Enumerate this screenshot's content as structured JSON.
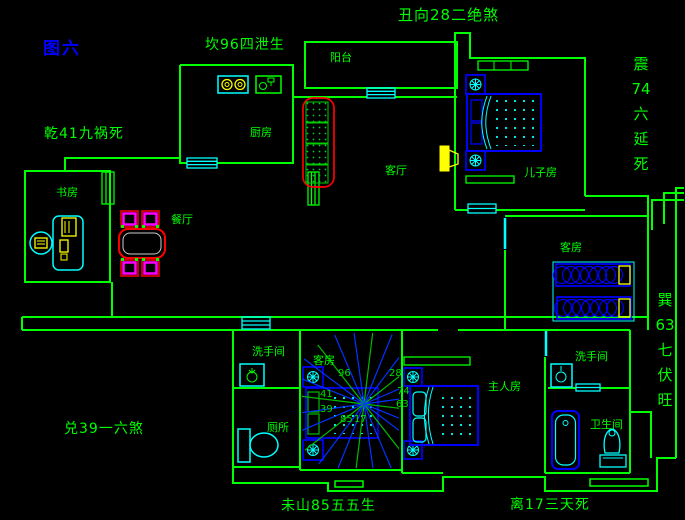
{
  "figure": {
    "label": "图六"
  },
  "fengshui_annotations": {
    "top_center": "丑向28二绝煞",
    "north_kan": "坎96四泄生",
    "northwest_qian": "乾41九祸死",
    "east_zhen": "震\n74\n六\n延\n死",
    "southeast_xun": "巽\n63\n七\n伏\n旺",
    "west_dui": "兑39一六煞",
    "bottom_mountain": "未山85五五生",
    "south_li": "离17三天死"
  },
  "rooms": {
    "balcony": "阳台",
    "kitchen": "厨房",
    "living_room": "客厅",
    "dining_room": "餐厅",
    "study": "书房",
    "son_room": "儿子房",
    "guest_room_right": "客房",
    "guest_room_center": "客房",
    "master_room": "主人房",
    "washroom_left": "洗手间",
    "washroom_right": "洗手间",
    "toilet": "厕所",
    "bathroom": "卫生间"
  },
  "compass": {
    "numbers": [
      "96",
      "28",
      "74",
      "63",
      "41",
      "39",
      "85",
      "17"
    ]
  },
  "colors": {
    "background": "#000000",
    "wall_green": "#00ff00",
    "text_green": "#00ff00",
    "figure_blue": "#0000ff",
    "furniture_blue": "#0000ff",
    "fixture_cyan": "#00ffff",
    "accent_red": "#ff0000",
    "accent_yellow": "#ffff00",
    "chair_magenta": "#ff00ff"
  }
}
